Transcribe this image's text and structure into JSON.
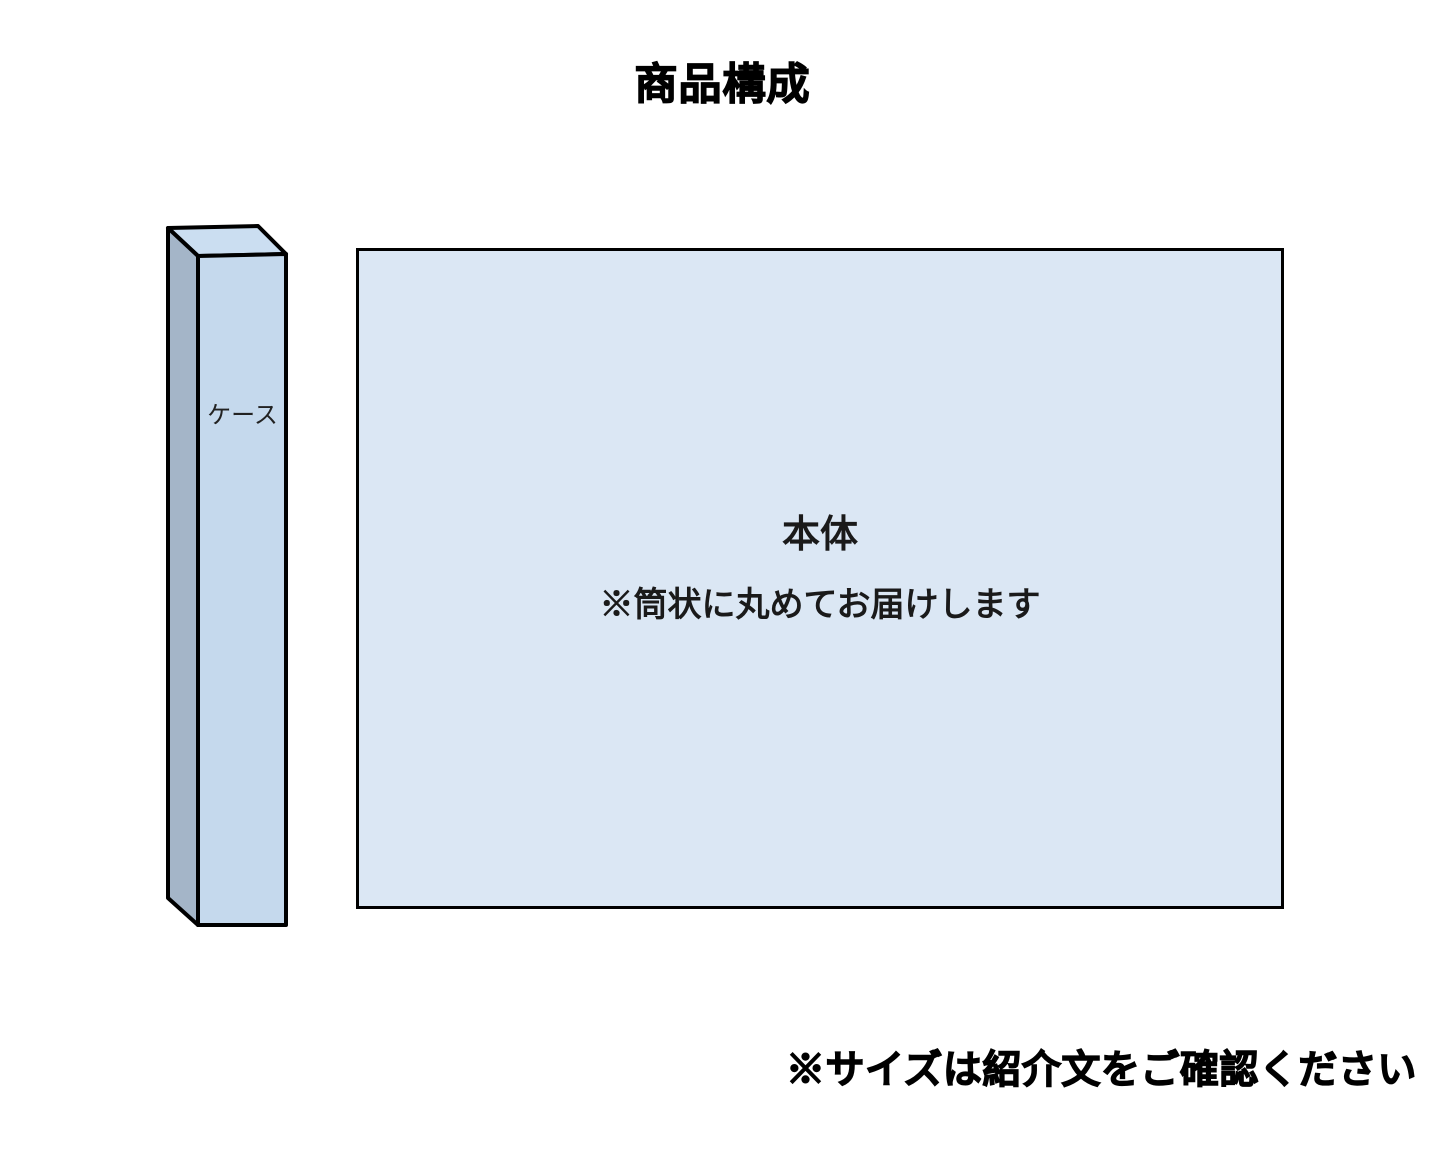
{
  "page": {
    "title": "商品構成",
    "background_color": "#ffffff",
    "text_color": "#000000"
  },
  "diagram": {
    "case": {
      "label": "ケース",
      "top_color": "#cbdef1",
      "front_color": "#c5d9ed",
      "side_color": "#a4b5c8",
      "outline_color": "#000000"
    },
    "body": {
      "label": "本体",
      "note": "※筒状に丸めてお届けします",
      "fill_color": "#dbe7f4",
      "outline_color": "#000000",
      "text_color": "#1a1a1a"
    }
  },
  "footer": {
    "note": "※サイズは紹介文をご確認ください"
  }
}
